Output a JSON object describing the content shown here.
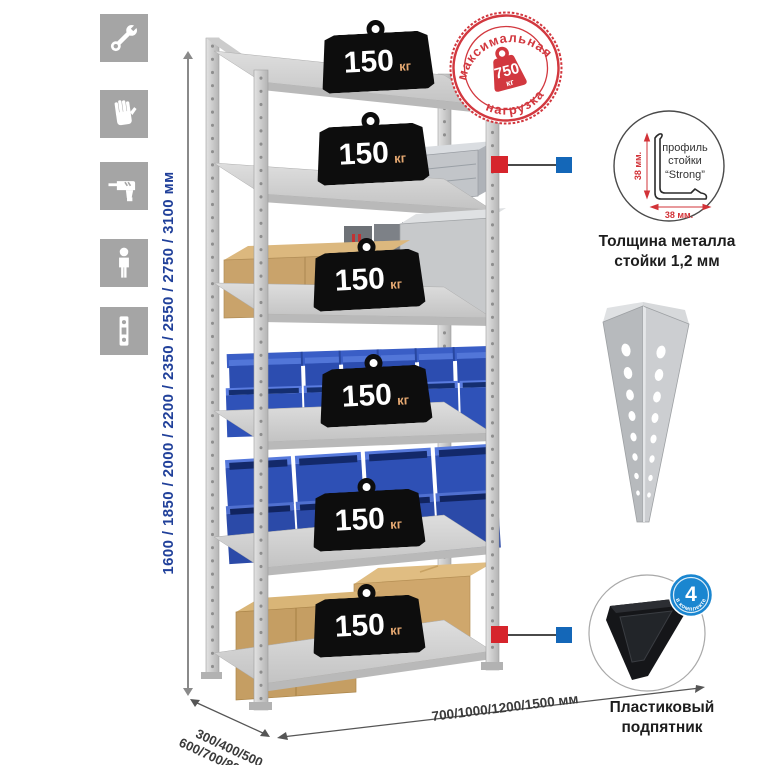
{
  "icons": {
    "wrench": "wrench-icon",
    "gloves": "gloves-icon",
    "drill": "drill-icon",
    "person": "person-icon",
    "level": "level-icon"
  },
  "height_dim": {
    "label": "1600 / 1850 / 2000 / 2200 / 2350 / 2550 / 2750 / 3100 мм"
  },
  "depth_dim": {
    "line1": "300/400/500",
    "line2": "600/700/800 мм"
  },
  "width_dim": {
    "label": "700/1000/1200/1500 мм"
  },
  "shelf_weight": {
    "value": "150",
    "unit": "кг"
  },
  "stamp": {
    "arc_top": "максимальная",
    "arc_bottom": "нагрузка",
    "value": "750",
    "unit": "кг"
  },
  "profile": {
    "line1": "профиль",
    "line2": "стойки",
    "line3": "“Strong”",
    "dim_vertical": "38 мм.",
    "dim_horizontal": "38 мм.",
    "caption1": "Толщина металла",
    "caption2": "стойки 1,2 мм"
  },
  "foot": {
    "badge_value": "4",
    "badge_arc": "в комплекте",
    "caption1": "Пластиковый",
    "caption2": "подпятник"
  },
  "colors": {
    "stamp_red": "#d2383f",
    "marker_red": "#d6252c",
    "marker_blue": "#1467b8",
    "badge_blue": "#1a86d0",
    "bin_blue": "#2f52b8",
    "height_text_blue": "#20409a",
    "icon_gray": "#a5a5a5",
    "metal_gray": "#c9c9c9"
  }
}
